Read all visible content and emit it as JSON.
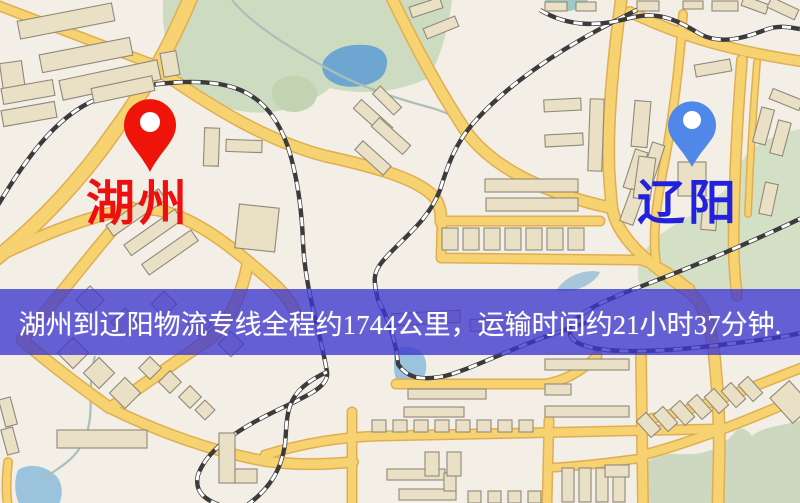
{
  "banner": {
    "text": "湖州到辽阳物流专线全程约1744公里，运输时间约21小时37分钟."
  },
  "route": {
    "origin": "湖州",
    "destination": "辽阳",
    "distance_km": "1744",
    "duration": "21小时37分钟"
  },
  "markers": {
    "origin": {
      "label": "湖州",
      "pin_color": "#ee1409"
    },
    "destination": {
      "label": "辽阳",
      "pin_color": "#4f88e8"
    }
  },
  "colors": {
    "pin_origin": "#ee1409",
    "pin_destination": "#4f88e8",
    "label_origin": "#ee1010",
    "label_destination": "#2222dd",
    "banner_bg": "rgba(60,54,206,0.78)",
    "banner_text": "#ffffff",
    "road_fill": "#f6d271",
    "road_casing": "#e0ae52",
    "building_fill": "#eae0c6",
    "building_stroke": "#90897a",
    "map_background": "#f3efe6",
    "park_green": "#cddcc0",
    "water_blue": "#6ea6d2"
  }
}
